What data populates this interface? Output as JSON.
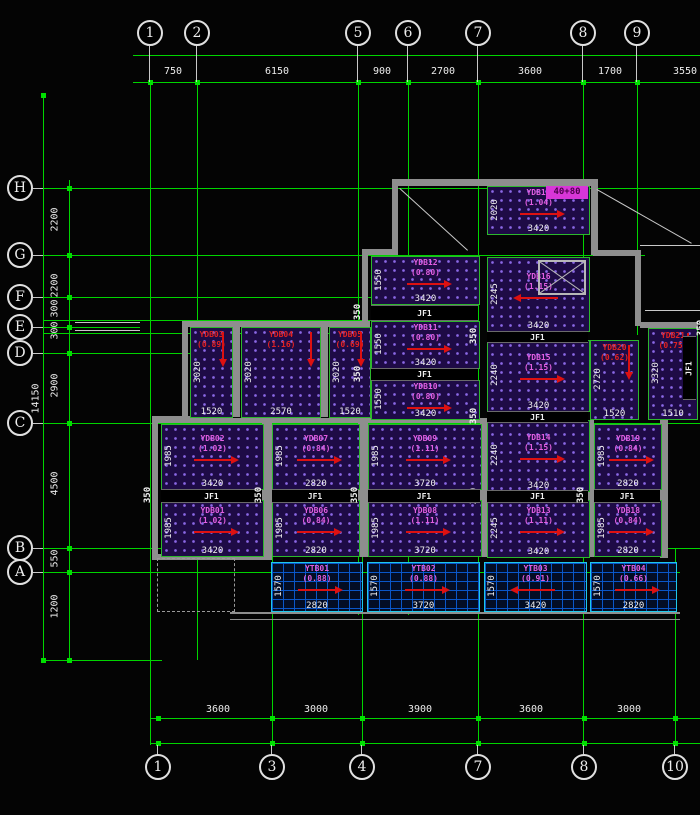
{
  "drawing": {
    "type": "structural-slab-reinforcement-plan",
    "colors": {
      "grid_green": "#00d400",
      "dim_text": "#ececec",
      "wall_gray": "#8e8e8e",
      "slab_hatch_bg": "#1e0b46",
      "slab_hatch_dot": "#8a68e6",
      "label_magenta": "#e25fe2",
      "label_red": "#e22222",
      "arrow_red": "#dd1111",
      "balcony_blue": "#0a5ad0",
      "balcony_border": "#1fc8e8",
      "highlight_magenta": "#d836d8",
      "bubble_stroke": "#e0e0e0"
    },
    "axes": {
      "top": {
        "bubbles": [
          {
            "label": "1",
            "x": 150
          },
          {
            "label": "2",
            "x": 197
          },
          {
            "label": "5",
            "x": 358
          },
          {
            "label": "6",
            "x": 408
          },
          {
            "label": "7",
            "x": 478
          },
          {
            "label": "8",
            "x": 583
          },
          {
            "label": "9",
            "x": 637
          }
        ],
        "dims": [
          {
            "text": "750",
            "x": 173
          },
          {
            "text": "6150",
            "x": 277
          },
          {
            "text": "900",
            "x": 382
          },
          {
            "text": "2700",
            "x": 443
          },
          {
            "text": "3600",
            "x": 530
          },
          {
            "text": "1700",
            "x": 610
          },
          {
            "text": "3550",
            "x": 685
          }
        ]
      },
      "bottom": {
        "bubbles": [
          {
            "label": "1",
            "x": 158
          },
          {
            "label": "3",
            "x": 272
          },
          {
            "label": "4",
            "x": 362
          },
          {
            "label": "7",
            "x": 478
          },
          {
            "label": "8",
            "x": 584
          },
          {
            "label": "10",
            "x": 675
          }
        ],
        "dims": [
          {
            "text": "3600",
            "x": 218
          },
          {
            "text": "3000",
            "x": 316
          },
          {
            "text": "3900",
            "x": 420
          },
          {
            "text": "3600",
            "x": 531
          },
          {
            "text": "3000",
            "x": 629
          }
        ]
      },
      "left": {
        "bubbles": [
          {
            "label": "H",
            "y": 188
          },
          {
            "label": "G",
            "y": 255
          },
          {
            "label": "F",
            "y": 297
          },
          {
            "label": "E",
            "y": 327
          },
          {
            "label": "D",
            "y": 353
          },
          {
            "label": "C",
            "y": 423
          },
          {
            "label": "B",
            "y": 548
          },
          {
            "label": "A",
            "y": 572
          }
        ],
        "dims": [
          {
            "text": "2200",
            "y": 221
          },
          {
            "text": "2200",
            "y": 287
          },
          {
            "text": "300",
            "y": 310
          },
          {
            "text": "300",
            "y": 332
          },
          {
            "text": "2900",
            "y": 387
          },
          {
            "text": "4500",
            "y": 485
          },
          {
            "text": "550",
            "y": 560
          },
          {
            "text": "1200",
            "y": 608
          }
        ],
        "overall_dim": {
          "text": "14150",
          "y": 400
        }
      }
    },
    "grid": {
      "v_lines": [
        {
          "x": 43,
          "y1": 95,
          "y2": 660
        },
        {
          "x": 69,
          "y1": 180,
          "y2": 660
        },
        {
          "x": 150,
          "y1": 82,
          "y2": 745
        },
        {
          "x": 197,
          "y1": 82,
          "y2": 660
        },
        {
          "x": 272,
          "y1": 423,
          "y2": 745
        },
        {
          "x": 358,
          "y1": 82,
          "y2": 615
        },
        {
          "x": 362,
          "y1": 548,
          "y2": 745
        },
        {
          "x": 408,
          "y1": 82,
          "y2": 615
        },
        {
          "x": 478,
          "y1": 82,
          "y2": 745
        },
        {
          "x": 583,
          "y1": 82,
          "y2": 745
        },
        {
          "x": 637,
          "y1": 82,
          "y2": 335
        },
        {
          "x": 675,
          "y1": 548,
          "y2": 745
        }
      ],
      "h_lines": [
        {
          "y": 55,
          "x1": 133,
          "x2": 700
        },
        {
          "y": 82,
          "x1": 133,
          "x2": 700
        },
        {
          "y": 188,
          "x1": 43,
          "x2": 700
        },
        {
          "y": 255,
          "x1": 43,
          "x2": 645
        },
        {
          "y": 297,
          "x1": 43,
          "x2": 408
        },
        {
          "y": 320,
          "x1": 43,
          "x2": 408
        },
        {
          "y": 327,
          "x1": 43,
          "x2": 140
        },
        {
          "y": 333,
          "x1": 43,
          "x2": 408
        },
        {
          "y": 353,
          "x1": 43,
          "x2": 195
        },
        {
          "y": 423,
          "x1": 43,
          "x2": 700
        },
        {
          "y": 548,
          "x1": 43,
          "x2": 700
        },
        {
          "y": 572,
          "x1": 43,
          "x2": 680
        },
        {
          "y": 660,
          "x1": 43,
          "x2": 162
        },
        {
          "y": 718,
          "x1": 150,
          "x2": 700
        },
        {
          "y": 743,
          "x1": 150,
          "x2": 700
        }
      ]
    },
    "walls": [
      [
        392,
        179,
        205,
        7
      ],
      [
        392,
        179,
        6,
        76
      ],
      [
        591,
        179,
        7,
        76
      ],
      [
        362,
        249,
        36,
        6
      ],
      [
        362,
        249,
        6,
        78
      ],
      [
        593,
        250,
        48,
        6
      ],
      [
        635,
        250,
        6,
        76
      ],
      [
        640,
        322,
        58,
        6
      ],
      [
        182,
        321,
        188,
        6
      ],
      [
        182,
        321,
        6,
        98
      ],
      [
        230,
        323,
        10,
        94
      ],
      [
        318,
        323,
        10,
        94
      ],
      [
        152,
        416,
        38,
        6
      ],
      [
        152,
        416,
        6,
        143
      ],
      [
        152,
        418,
        335,
        5
      ],
      [
        262,
        420,
        10,
        137
      ],
      [
        358,
        420,
        10,
        137
      ],
      [
        480,
        420,
        8,
        137
      ],
      [
        586,
        420,
        8,
        137
      ],
      [
        660,
        418,
        8,
        140
      ],
      [
        152,
        554,
        120,
        6
      ],
      [
        230,
        612,
        450,
        2
      ],
      [
        230,
        619,
        450,
        1
      ]
    ],
    "white_lines": [
      {
        "x1": 400,
        "y1": 188,
        "x2": 468,
        "y2": 250
      },
      {
        "x1": 597,
        "y1": 189,
        "x2": 692,
        "y2": 243
      },
      {
        "x1": 640,
        "y1": 245,
        "x2": 700,
        "y2": 245
      },
      {
        "x1": 645,
        "y1": 310,
        "x2": 700,
        "y2": 310
      },
      {
        "x1": 75,
        "y1": 322,
        "x2": 140,
        "y2": 322
      },
      {
        "x1": 75,
        "y1": 330,
        "x2": 140,
        "y2": 330
      }
    ],
    "dashed_rect": {
      "x": 157,
      "y": 558,
      "w": 76,
      "h": 52
    },
    "panels": [
      {
        "id": "YDB17",
        "value": "(1.04)",
        "x": 487,
        "y": 186,
        "w": 101,
        "h": 47,
        "dimW": "3420",
        "dimH": "2020",
        "labelColor": "magenta",
        "arrow": "right",
        "kind": "slab"
      },
      {
        "id": "YDB16",
        "value": "(1.15)",
        "x": 487,
        "y": 257,
        "w": 101,
        "h": 73,
        "dimW": "3420",
        "dimH": "2245",
        "labelColor": "magenta",
        "arrow": "left",
        "kind": "slab"
      },
      {
        "id": "YDB15",
        "value": "(1.15)",
        "x": 487,
        "y": 340,
        "w": 101,
        "h": 70,
        "dimW": "3420",
        "dimH": "2240",
        "labelColor": "magenta",
        "arrow": "right",
        "kind": "slab"
      },
      {
        "id": "YDB14",
        "value": "(1.15)",
        "x": 487,
        "y": 420,
        "w": 101,
        "h": 70,
        "dimW": "3420",
        "dimH": "2240",
        "labelColor": "magenta",
        "arrow": "right",
        "kind": "slab"
      },
      {
        "id": "YDB13",
        "value": "(1.11)",
        "x": 487,
        "y": 500,
        "w": 101,
        "h": 56,
        "dimW": "3420",
        "dimH": "2245",
        "labelColor": "magenta",
        "arrow": "right",
        "kind": "slab"
      },
      {
        "id": "YDB12",
        "value": "(0.80)",
        "x": 371,
        "y": 256,
        "w": 107,
        "h": 47,
        "dimW": "3420",
        "dimH": "1550",
        "labelColor": "magenta",
        "arrow": "right",
        "kind": "slab"
      },
      {
        "id": "YDB11",
        "value": "(0.80)",
        "x": 371,
        "y": 321,
        "w": 107,
        "h": 46,
        "dimW": "3420",
        "dimH": "1550",
        "labelColor": "magenta",
        "arrow": "right",
        "kind": "slab"
      },
      {
        "id": "YDB10",
        "value": "(0.80)",
        "x": 371,
        "y": 380,
        "w": 107,
        "h": 38,
        "dimW": "3420",
        "dimH": "1550",
        "labelColor": "magenta",
        "arrow": "right",
        "kind": "slab"
      },
      {
        "id": "YDB03",
        "value": "(0.89)",
        "x": 190,
        "y": 327,
        "w": 41,
        "h": 89,
        "dimW": "1520",
        "dimH": "3020",
        "labelColor": "red",
        "arrow": "down",
        "kind": "slab"
      },
      {
        "id": "YDB04",
        "value": "(1.16)",
        "x": 241,
        "y": 327,
        "w": 78,
        "h": 89,
        "dimW": "2570",
        "dimH": "3020",
        "labelColor": "red",
        "arrow": "down",
        "kind": "slab"
      },
      {
        "id": "YDB05",
        "value": "(0.69)",
        "x": 329,
        "y": 327,
        "w": 40,
        "h": 89,
        "dimW": "1520",
        "dimH": "3020",
        "labelColor": "red",
        "arrow": "down",
        "kind": "slab"
      },
      {
        "id": "YDB02",
        "value": "(1.02)",
        "x": 161,
        "y": 424,
        "w": 101,
        "h": 64,
        "dimW": "3420",
        "dimH": "1985",
        "labelColor": "magenta",
        "arrow": "right",
        "kind": "slab"
      },
      {
        "id": "YDB01",
        "value": "(1.02)",
        "x": 161,
        "y": 500,
        "w": 101,
        "h": 55,
        "dimW": "3420",
        "dimH": "1985",
        "labelColor": "magenta",
        "arrow": "right",
        "kind": "slab"
      },
      {
        "id": "YDB07",
        "value": "(0.84)",
        "x": 272,
        "y": 424,
        "w": 86,
        "h": 64,
        "dimW": "2820",
        "dimH": "1985",
        "labelColor": "magenta",
        "arrow": "right",
        "kind": "slab"
      },
      {
        "id": "YDB06",
        "value": "(0.84)",
        "x": 272,
        "y": 500,
        "w": 86,
        "h": 55,
        "dimW": "2820",
        "dimH": "1985",
        "labelColor": "magenta",
        "arrow": "right",
        "kind": "slab"
      },
      {
        "id": "YDB09",
        "value": "(1.11)",
        "x": 368,
        "y": 424,
        "w": 112,
        "h": 64,
        "dimW": "3720",
        "dimH": "1985",
        "labelColor": "magenta",
        "arrow": "right",
        "kind": "slab"
      },
      {
        "id": "YDB08",
        "value": "(1.11)",
        "x": 368,
        "y": 500,
        "w": 112,
        "h": 55,
        "dimW": "3720",
        "dimH": "1985",
        "labelColor": "magenta",
        "arrow": "right",
        "kind": "slab"
      },
      {
        "id": "YDB19",
        "value": "(0.84)",
        "x": 594,
        "y": 424,
        "w": 66,
        "h": 64,
        "dimW": "2820",
        "dimH": "1985",
        "labelColor": "magenta",
        "arrow": "right",
        "kind": "slab"
      },
      {
        "id": "YDB18",
        "value": "(0.84)",
        "x": 594,
        "y": 500,
        "w": 66,
        "h": 55,
        "dimW": "2820",
        "dimH": "1985",
        "labelColor": "magenta",
        "arrow": "right",
        "kind": "slab"
      },
      {
        "id": "YDB20",
        "value": "(0.62)",
        "x": 590,
        "y": 340,
        "w": 47,
        "h": 78,
        "dimW": "1520",
        "dimH": "2720",
        "labelColor": "red",
        "arrow": "down",
        "kind": "slab"
      },
      {
        "id": "YDB21",
        "value": "(0.75)",
        "x": 648,
        "y": 328,
        "w": 48,
        "h": 90,
        "dimW": "1510",
        "dimH": "3320",
        "labelColor": "red",
        "arrow": "down",
        "kind": "slab"
      },
      {
        "id": "YTB01",
        "value": "(0.88)",
        "x": 271,
        "y": 562,
        "w": 90,
        "h": 48,
        "dimW": "2820",
        "dimH": "1570",
        "labelColor": "magenta",
        "arrow": "right",
        "kind": "balcony"
      },
      {
        "id": "YTB02",
        "value": "(0.88)",
        "x": 367,
        "y": 562,
        "w": 111,
        "h": 48,
        "dimW": "3720",
        "dimH": "1570",
        "labelColor": "magenta",
        "arrow": "right",
        "kind": "balcony"
      },
      {
        "id": "YTB03",
        "value": "(0.91)",
        "x": 484,
        "y": 562,
        "w": 101,
        "h": 48,
        "dimW": "3420",
        "dimH": "1570",
        "labelColor": "magenta",
        "arrow": "left",
        "kind": "balcony"
      },
      {
        "id": "YTB04",
        "value": "(0.66)",
        "x": 590,
        "y": 562,
        "w": 85,
        "h": 48,
        "dimW": "2820",
        "dimH": "1570",
        "labelColor": "magenta",
        "arrow": "right",
        "kind": "balcony"
      }
    ],
    "strips": [
      {
        "label": "JF1",
        "dim": "350",
        "x": 371,
        "y": 305,
        "w": 107,
        "h": 14,
        "vertical": false
      },
      {
        "label": "JF1",
        "dim": "350",
        "x": 371,
        "y": 368,
        "w": 107,
        "h": 11,
        "vertical": false
      },
      {
        "label": "JF1",
        "dim": "350",
        "x": 487,
        "y": 331,
        "w": 101,
        "h": 10,
        "vertical": false
      },
      {
        "label": "JF1",
        "dim": "350",
        "x": 487,
        "y": 411,
        "w": 101,
        "h": 10,
        "vertical": false
      },
      {
        "label": "JF1",
        "dim": "350",
        "x": 487,
        "y": 490,
        "w": 101,
        "h": 11,
        "vertical": false
      },
      {
        "label": "JF1",
        "dim": "350",
        "x": 161,
        "y": 489,
        "w": 101,
        "h": 12,
        "vertical": false
      },
      {
        "label": "JF1",
        "dim": "350",
        "x": 272,
        "y": 489,
        "w": 86,
        "h": 12,
        "vertical": false
      },
      {
        "label": "JF1",
        "dim": "350",
        "x": 368,
        "y": 489,
        "w": 112,
        "h": 12,
        "vertical": false
      },
      {
        "label": "JF1",
        "dim": "350",
        "x": 594,
        "y": 489,
        "w": 66,
        "h": 12,
        "vertical": false
      },
      {
        "label": "JF1",
        "dim": "350",
        "x": 683,
        "y": 336,
        "w": 13,
        "h": 62,
        "vertical": true
      }
    ],
    "shaft_box": {
      "x": 538,
      "y": 260,
      "w": 48,
      "h": 35
    },
    "highlight": {
      "text": "40+80",
      "x": 546,
      "y": 186,
      "w": 42,
      "h": 13
    }
  }
}
